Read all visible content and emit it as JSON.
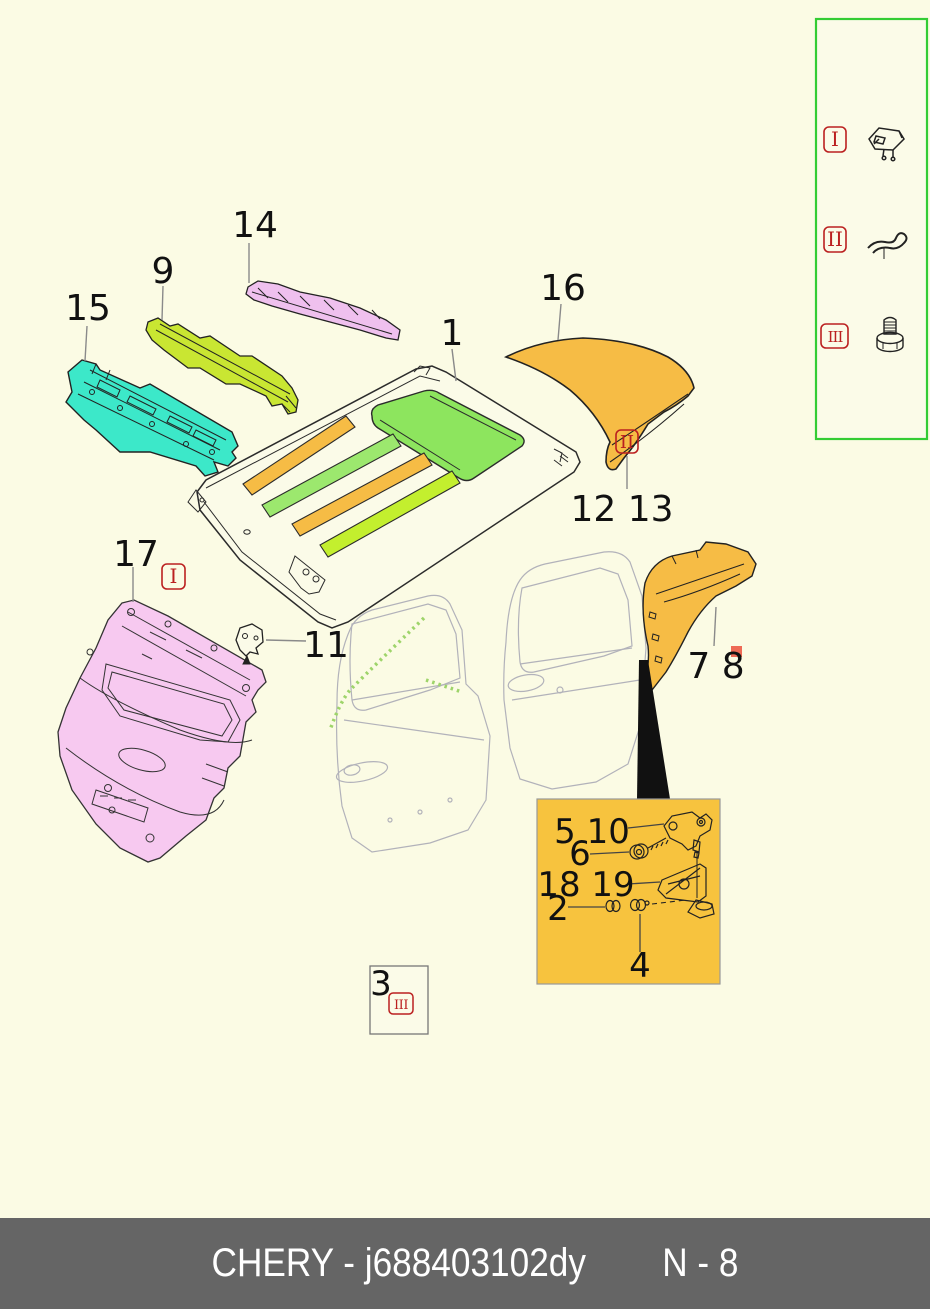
{
  "title": "CHERY body parts diagram page",
  "footer": {
    "brand": "CHERY",
    "part_code": "j688403102dy",
    "left_text": "CHERY - j688403102dy",
    "page_ref": "N - 8",
    "bg": "#656565",
    "text_color": "#ffffff"
  },
  "legend": {
    "border_color": "#33cc33",
    "items": [
      {
        "numeral": "I",
        "icon": "retainer-clip-icon"
      },
      {
        "numeral": "II",
        "icon": "hook-clamp-icon"
      },
      {
        "numeral": "III",
        "icon": "flange-bolt-icon"
      }
    ]
  },
  "badges": {
    "i": "I",
    "ii": "II",
    "iii": "III"
  },
  "labels": {
    "n1": "1",
    "n9": "9",
    "n14": "14",
    "n15": "15",
    "n16": "16",
    "n17": "17",
    "n11": "11",
    "n12_13": "12 13",
    "n7_8": "7 8",
    "n3": "3",
    "n5_10": "5 10",
    "n6": "6",
    "n18_19": "18 19",
    "n2": "2",
    "n4": "4"
  },
  "parts": [
    {
      "callout": "1",
      "name": "roof-panel",
      "fill": "outline"
    },
    {
      "callout": "9",
      "name": "roof-front-bow-rail",
      "fill": "#c9e632"
    },
    {
      "callout": "14",
      "name": "roof-rear-crossmember",
      "fill": "#efc0ee"
    },
    {
      "callout": "15",
      "name": "rear-shelf-panel",
      "fill": "#3ce8c9"
    },
    {
      "callout": "16",
      "name": "rear-sail-panel",
      "fill": "#f6bc45"
    },
    {
      "callout": "17",
      "name": "tailgate",
      "fill": "#f7c9f0"
    },
    {
      "callout": "7 8",
      "name": "quarter-inner-panel",
      "fill": "#f6bc45"
    },
    {
      "callout": "11",
      "name": "small-bracket",
      "fill": "outline"
    },
    {
      "callout": "12 13",
      "name": "fastener-reference",
      "fastener_type": "II"
    },
    {
      "callout": "3",
      "name": "fastener-reference",
      "fastener_type": "III"
    },
    {
      "callout": "5 10 · 6 · 18 19 · 2 · 4",
      "name": "tailgate-hinge-detail-inset",
      "fill": "#f7c33e"
    }
  ],
  "colors": {
    "background": "#fbfbe4",
    "legend_border": "#33cc33",
    "badge_red": "#bb2020",
    "inset_bg": "#f7c33e",
    "footer_bg": "#656565",
    "teal": "#3ce8c9",
    "chartreuse": "#c9e632",
    "pink_rail": "#efc0ee",
    "pink_tailgate": "#f7c9f0",
    "orange": "#f6bc45",
    "sunroof_green": "#8de55e",
    "strip_green": "#9ce86e",
    "strip_yellow": "#c3ef2e",
    "seal_green": "#9ed46a",
    "marker_red": "#ee6a55",
    "wedge_black": "#111111"
  }
}
